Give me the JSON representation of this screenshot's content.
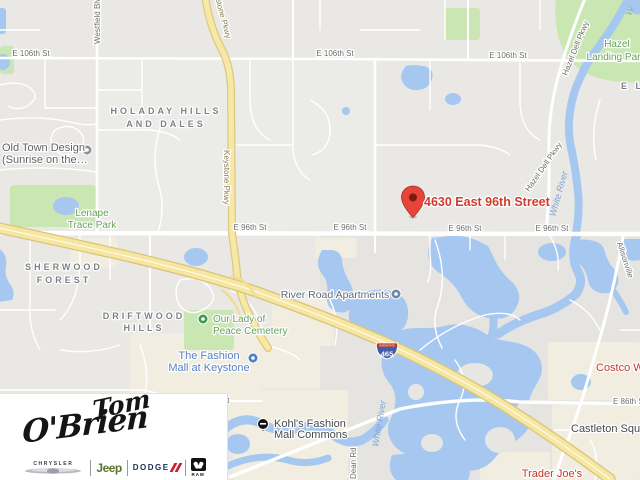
{
  "map": {
    "destination": {
      "label": "4630 East 96th Street"
    },
    "streets": {
      "e106_1": "E 106th St",
      "e106_2": "E 106th St",
      "e106_3": "E 106th St",
      "e96_1": "E 96th St",
      "e96_2": "E 96th St",
      "e96_3": "E 96th St",
      "e96_4": "E 96th St",
      "e86_right": "E 86th St",
      "e86_left": "E 86th St",
      "westfield": "Westfield Blvd",
      "keystone_top": "Keystone Pkwy",
      "keystone_mid": "Keystone Pkwy",
      "hazeldell_top": "Hazel Dell Pkwy",
      "hazeldell_mid": "Hazel Dell Pkwy",
      "allisonville": "Allisonville",
      "dean": "Dean Rd"
    },
    "neighborhoods": {
      "holaday_line1": "HOLADAY HILLS",
      "holaday_line2": "AND DALES",
      "sherwood_line1": "SHERWOOD",
      "sherwood_line2": "FOREST",
      "driftwood_line1": "DRIFTWOOD",
      "driftwood_line2": "HILLS",
      "partial_right_edge": "E L"
    },
    "parks": {
      "lenape_line1": "Lenape",
      "lenape_line2": "Trace Park",
      "hazel_line1": "Hazel",
      "hazel_line2": "Landing Park",
      "cemetery_line1": "Our Lady of",
      "cemetery_line2": "Peace Cemetery"
    },
    "pois": {
      "oldtown_line1": "Old Town Design",
      "oldtown_line2": "(Sunrise on the…",
      "river_road_apartments": "River Road Apartments",
      "fashion_line1": "The Fashion",
      "fashion_line2": "Mall at Keystone",
      "kohls_line1": "Kohl's Fashion",
      "kohls_line2": "Mall Commons",
      "costco": "Costco Wholesale",
      "castleton": "Castleton Square",
      "trader_joes": "Trader Joe's"
    },
    "water_labels": {
      "white_river_north": "White River",
      "white_river_south": "White River",
      "corner_w": "W"
    },
    "shield": {
      "top_text": "INTERSTATE",
      "number": "465"
    },
    "colors": {
      "water": "#a6c8f0",
      "park": "#c9e6b3",
      "commercial": "#f1ede0",
      "highway_fill": "#f7e6a0",
      "road_white": "#ffffff",
      "destination_red": "#d23b2c",
      "pin_red": "#e8453a"
    }
  },
  "logo": {
    "script_top": "Tom",
    "script_bottom": "O'Brien",
    "brands": {
      "chrysler": "CHRYSLER",
      "jeep": "Jeep",
      "dodge": "DODGE",
      "ram": "RAM"
    }
  }
}
